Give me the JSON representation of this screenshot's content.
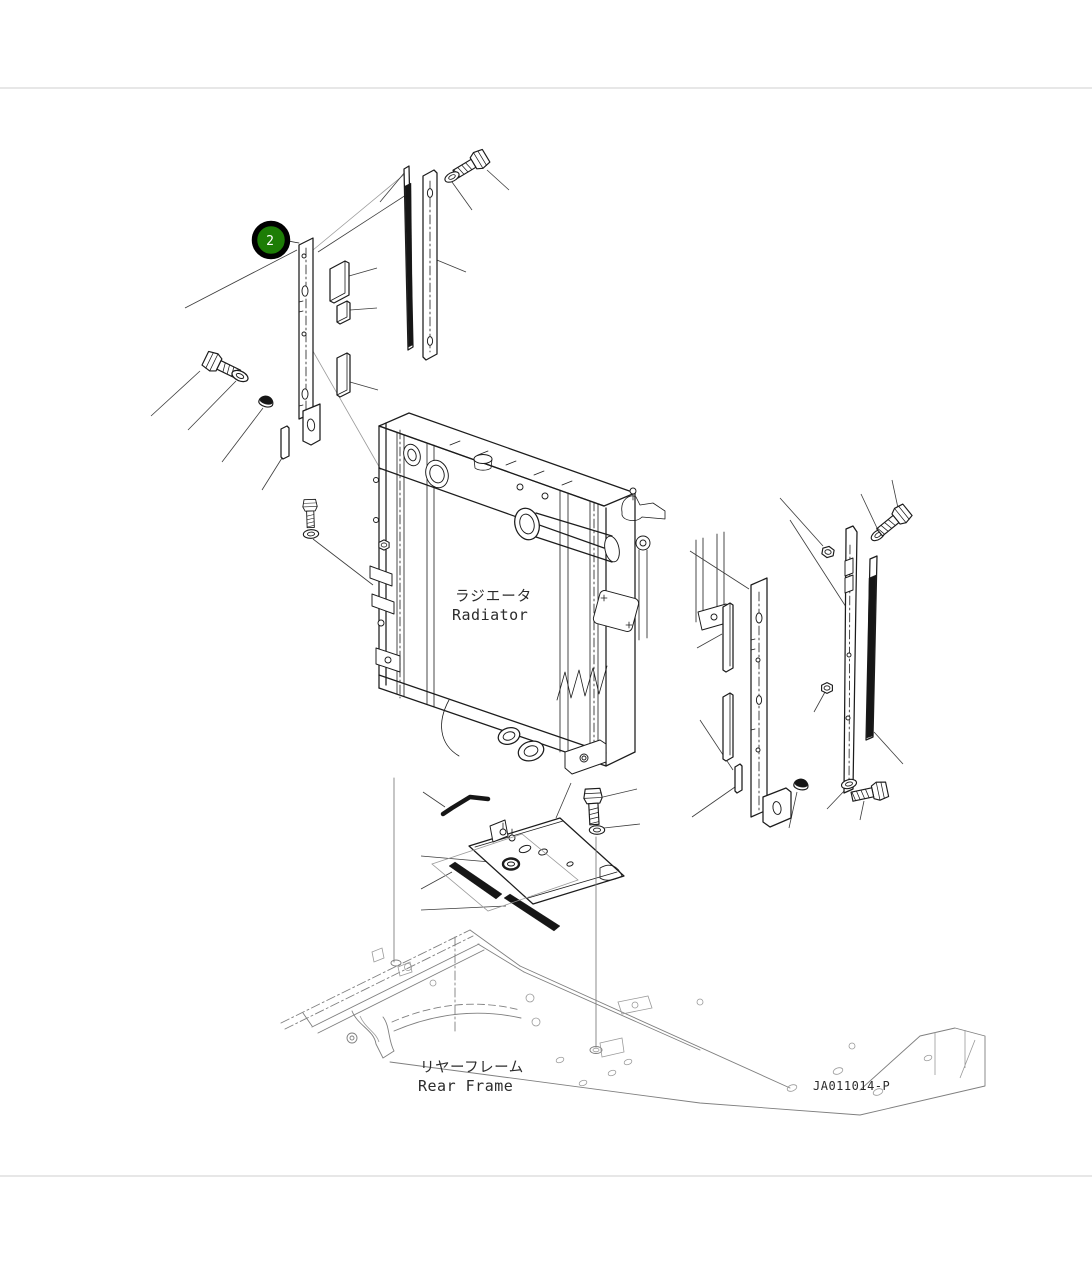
{
  "page": {
    "background": "#ffffff",
    "width": 1092,
    "height": 1261
  },
  "diagram": {
    "type": "exploded-parts-diagram",
    "drawing_number": "JA011014-P",
    "callouts": [
      {
        "number": "2",
        "color": "#1d7d06"
      }
    ],
    "labels": {
      "radiator": {
        "ja": "ラジエータ",
        "en": "Radiator"
      },
      "rear_frame": {
        "ja": "リヤーフレーム",
        "en": "Rear Frame"
      }
    },
    "parts_shown": [
      "side-bracket-left",
      "seal-pads",
      "seal-strips",
      "hex-bolts",
      "washers",
      "grommets",
      "nuts",
      "radiator",
      "side-bracket-right",
      "bottom-seal-plate",
      "bent-rod",
      "rear-frame"
    ],
    "colors": {
      "line": "#1c1c1c",
      "leader_line": "#3c3c3c",
      "light_line": "#9a9a9a",
      "frame_line": "#7f7f7f",
      "seal_fill": "#161616",
      "callout_green": "#1d7d06",
      "callout_ring": "#000000",
      "callout_text": "#ffffff",
      "label_text": "#2b2b2b"
    }
  }
}
